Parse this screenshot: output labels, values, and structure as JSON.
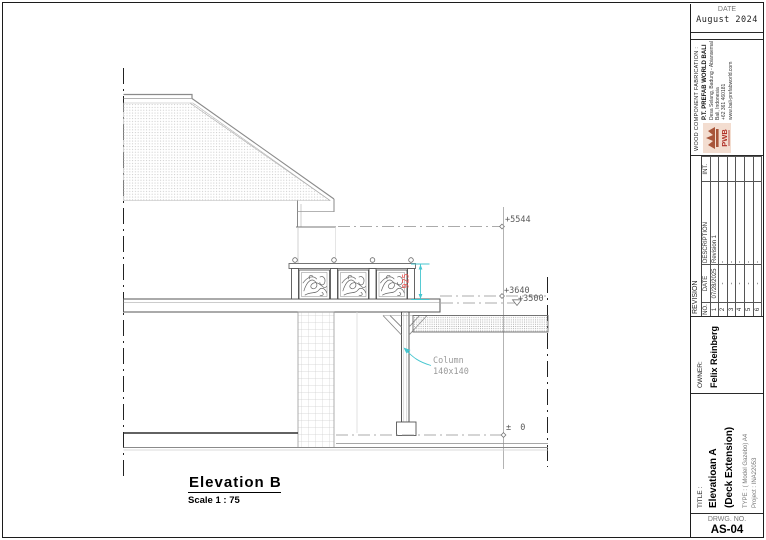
{
  "title_block": {
    "date": {
      "label": "DATE",
      "value": "August 2024"
    },
    "company": {
      "section_label": "WOOD COMPONENT FABRICATION :",
      "name": "P.T. PREFAB WORLD BALI",
      "address1": "Desa Selang, Badung - Abiansemal",
      "address2": "Bali, Indonesia",
      "phone": "+62 361 460181",
      "website": "www.bali-prefabworld.com",
      "logo_text": "PWB"
    },
    "revision": {
      "title": "REVISION",
      "columns": {
        "no": "NO.",
        "date": "DATE",
        "description": "DESCRIPTION",
        "int": "INT."
      },
      "rows": [
        {
          "no": "1",
          "date": "07/28/2025",
          "description": "Revision 1",
          "int": ""
        },
        {
          "no": "2",
          "date": "-",
          "description": "-",
          "int": ""
        },
        {
          "no": "3",
          "date": "-",
          "description": "-",
          "int": ""
        },
        {
          "no": "4",
          "date": "-",
          "description": "-",
          "int": ""
        },
        {
          "no": "5",
          "date": "-",
          "description": "-",
          "int": ""
        },
        {
          "no": "6",
          "date": "-",
          "description": "-",
          "int": ""
        }
      ]
    },
    "owner": {
      "label": "OWNER:",
      "name": "Felix Reinberg"
    },
    "title": {
      "label": "TITLE :",
      "line1": "Elevatioan A",
      "line2": "(Deck Extension)",
      "type_line": "TYPE : ( Model Gazebo)  A4",
      "project_line": "Project : INA22053"
    },
    "drawing_number": {
      "label": "DRWG. NO.",
      "value": "AS-04"
    }
  },
  "drawing": {
    "view_title": "Elevation B",
    "scale": "Scale 1 : 75",
    "levels": {
      "ridge": "+5544",
      "beam": "+3640",
      "deck_roof": "+3500",
      "ground": "± 0"
    },
    "railing_height_dim": "925",
    "column_label": {
      "line1": "Column",
      "line2": "140x140"
    },
    "colors": {
      "dim_cyan": "#45c6cf",
      "dim_red": "#ef5350",
      "hatch_gray": "#c9c9c9"
    }
  }
}
